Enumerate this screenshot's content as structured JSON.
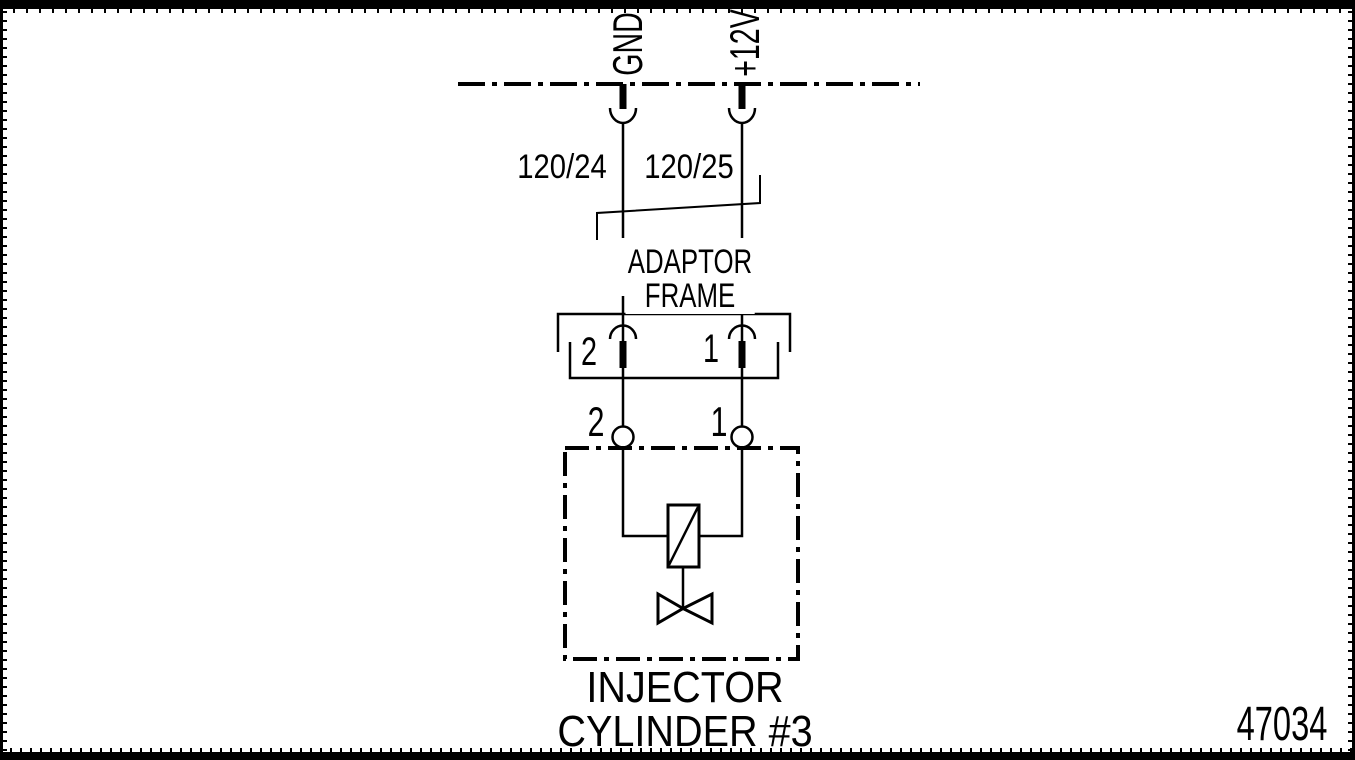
{
  "figure": {
    "number": "47034"
  },
  "power_rail": {
    "gnd_label": "GND",
    "plus12v_label": "+12V"
  },
  "wires": {
    "wire_a_label": "120/24",
    "wire_b_label": "120/25"
  },
  "adaptor_frame": {
    "label_line1": "ADAPTOR",
    "label_line2": "FRAME",
    "pin_left": "2",
    "pin_right": "1"
  },
  "injector": {
    "terminal_left": "2",
    "terminal_right": "1",
    "label_line1": "INJECTOR",
    "label_line2": "CYLINDER #3"
  },
  "colors": {
    "ink": "#000000",
    "paper": "#ffffff"
  }
}
